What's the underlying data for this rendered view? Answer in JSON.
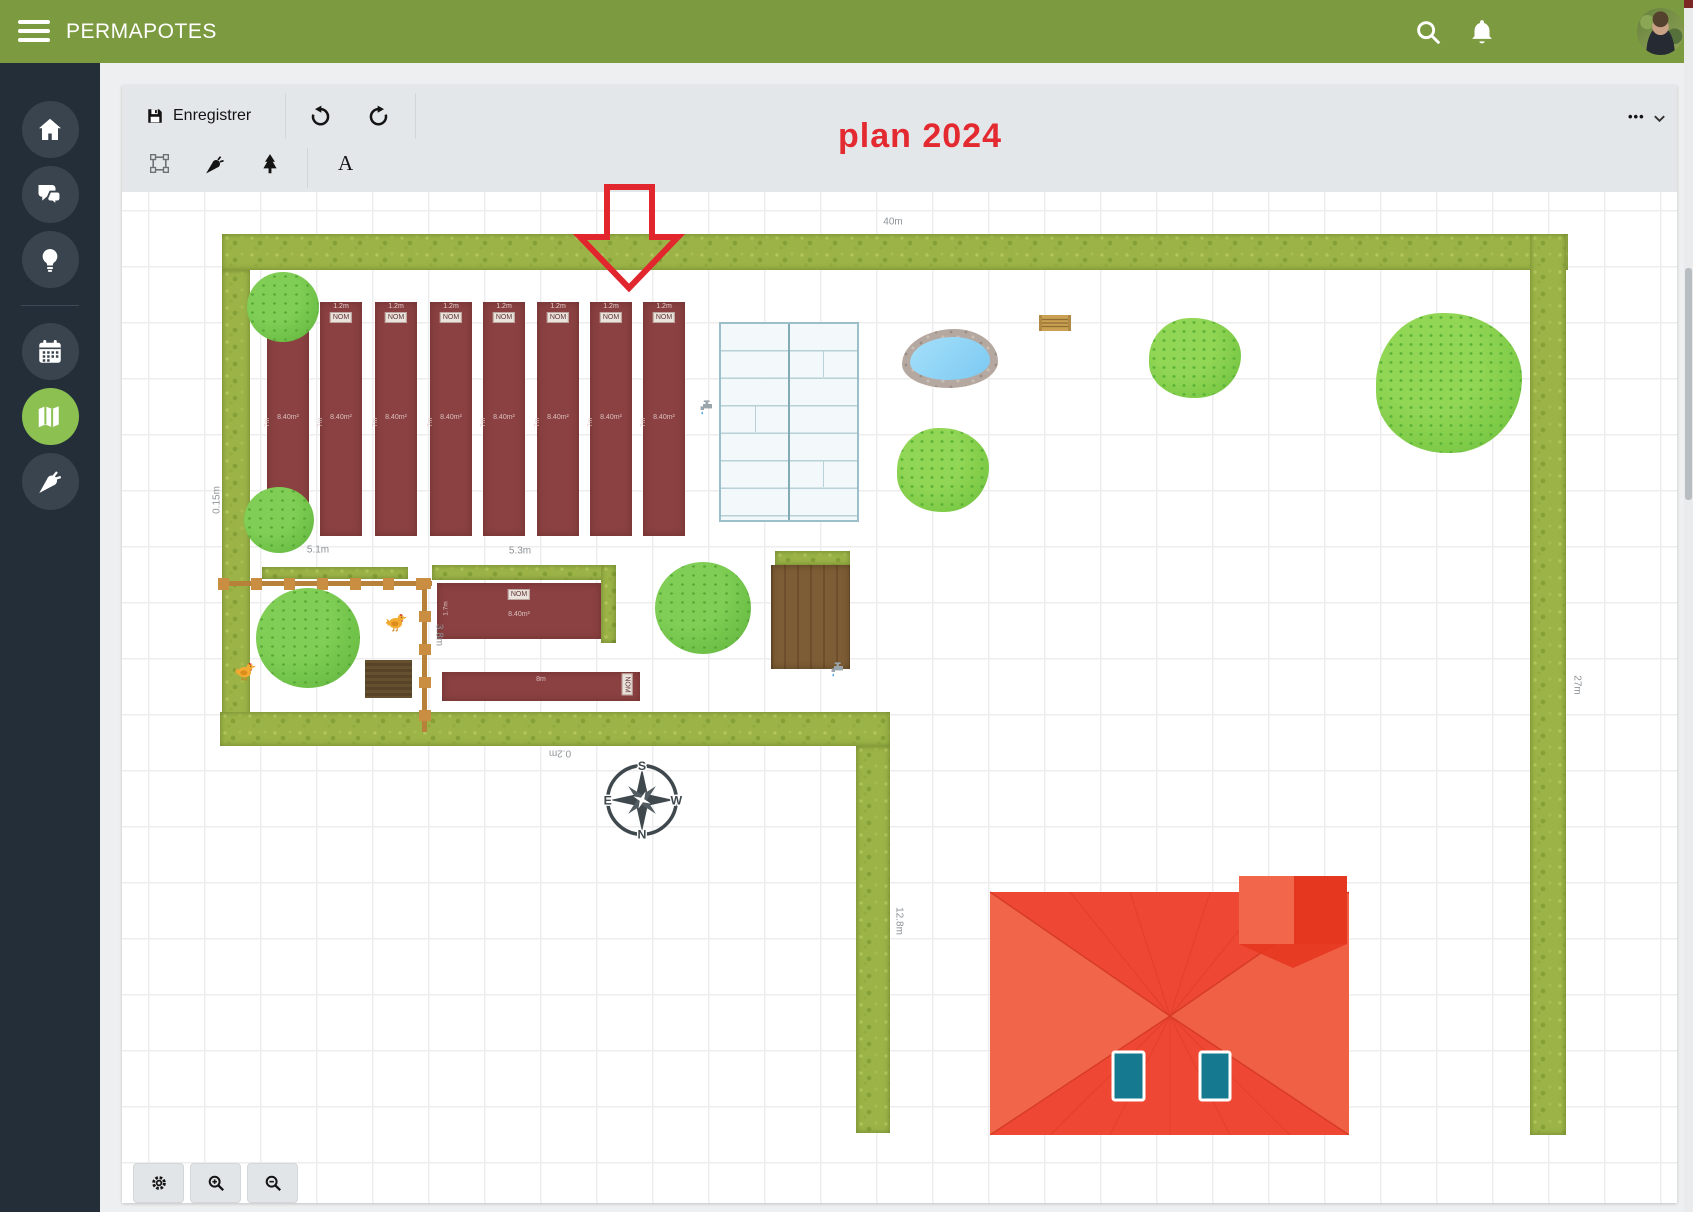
{
  "header": {
    "title": "PERMAPOTES"
  },
  "sidebar": {
    "items": [
      {
        "id": "home",
        "icon": "home-icon",
        "active": false
      },
      {
        "id": "community",
        "icon": "chat-icon",
        "active": false
      },
      {
        "id": "ideas",
        "icon": "lightbulb-icon",
        "active": false
      },
      {
        "id": "calendar",
        "icon": "calendar-icon",
        "active": false
      },
      {
        "id": "plan",
        "icon": "map-icon",
        "active": true
      },
      {
        "id": "garden",
        "icon": "carrot-icon",
        "active": false
      }
    ]
  },
  "toolbar": {
    "save_label": "Enregistrer",
    "more_label": "•••",
    "text_tool_label": "A"
  },
  "plan": {
    "annotation": "plan 2024",
    "compass": {
      "top": "S",
      "right": "W",
      "bottom": "N",
      "left": "E"
    },
    "beds": {
      "vertical_xs": [
        145,
        198,
        253,
        308,
        361,
        415,
        468,
        521
      ],
      "y": 110,
      "w": 42,
      "h": 234,
      "width_label": "1.2m",
      "name_label": "NOM",
      "length_label": "7m",
      "area_label": "8.40m²"
    },
    "bed_h1": {
      "name_label": "NOM",
      "area_label": "8.40m²",
      "side_label": "1.7m"
    },
    "bed_h2": {
      "area_label": "8m",
      "name_label": "NOM"
    },
    "measurements": [
      {
        "text": "40m",
        "x": 771,
        "y": 30,
        "rot": 0
      },
      {
        "text": "0.15m",
        "x": 95,
        "y": 308,
        "rot": -90
      },
      {
        "text": "5.1m",
        "x": 196,
        "y": 358,
        "rot": 0
      },
      {
        "text": "5.3m",
        "x": 398,
        "y": 359,
        "rot": 0
      },
      {
        "text": "27m",
        "x": 1455,
        "y": 493,
        "rot": 90
      },
      {
        "text": "3.8m",
        "x": 317,
        "y": 443,
        "rot": 90
      },
      {
        "text": "0.2m",
        "x": 438,
        "y": 561,
        "rot": 180
      },
      {
        "text": "12.8m",
        "x": 777,
        "y": 729,
        "rot": 90
      }
    ]
  }
}
